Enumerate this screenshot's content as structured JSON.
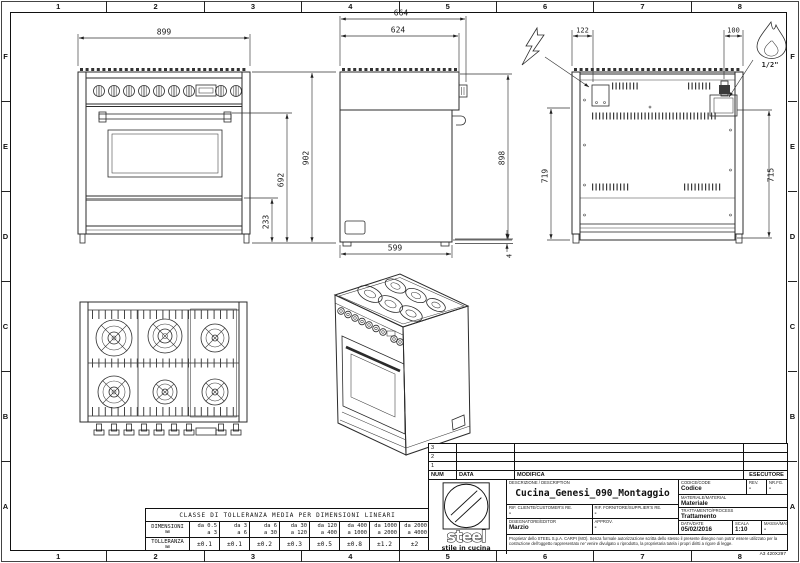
{
  "sheet": {
    "format_label": "A3 420X297",
    "grid_cols": [
      "1",
      "2",
      "3",
      "4",
      "5",
      "6",
      "7",
      "8"
    ],
    "grid_rows": [
      "F",
      "E",
      "D",
      "C",
      "B",
      "A"
    ]
  },
  "drawing": {
    "front_view": {
      "width": "899",
      "height": "902",
      "oven_height": "692",
      "plinth_height": "233"
    },
    "side_view": {
      "depth_total": "664",
      "depth_top": "624",
      "height_body": "898",
      "depth_base": "599",
      "foot": "4"
    },
    "rear_view": {
      "electrical_offset": "122",
      "gas_offset": "100",
      "height_left": "719",
      "height_right": "715",
      "gas_fitting": "1/2\""
    }
  },
  "tolerance_table": {
    "title": "CLASSE DI TOLLERANZA MEDIA PER DIMENSIONI LINEARI",
    "dim_label_1": "DIMENSIONI",
    "dim_label_2": "mm",
    "tol_label_1": "TOLLERANZA",
    "tol_label_2": "mm",
    "range_from": [
      "da 0.5",
      "da 3",
      "da 6",
      "da 30",
      "da 120",
      "da 400",
      "da 1000",
      "da 2000"
    ],
    "range_to": [
      "a 3",
      "a 6",
      "a 30",
      "a 120",
      "a 400",
      "a 1000",
      "a 2000",
      "a 4000"
    ],
    "values": [
      "±0.1",
      "±0.1",
      "±0.2",
      "±0.3",
      "±0.5",
      "±0.8",
      "±1.2",
      "±2"
    ]
  },
  "revision_table": {
    "rows": [
      "3",
      "2",
      "1"
    ],
    "col_num": "NUM",
    "col_data": "DATA",
    "col_modifica": "MODIFICA",
    "col_esecutore": "ESECUTORE"
  },
  "title_block": {
    "logo_word": "steel",
    "logo_tagline": "stile in cucina",
    "description_label": "DESCRIZIONE / DESCRIPTION",
    "description": "Cucina_Genesi_090_Montaggio",
    "codice_label": "CODICE/CODE",
    "codice": "Codice",
    "rev_label": "REV.",
    "rev": "-",
    "nrfg_label": "NR.FG.",
    "nrfg": "-",
    "materiale_label": "MATERIALE/MATERIAL",
    "materiale": "Materiale",
    "trattamento_label": "TRATTAMENTO/PROCESS",
    "trattamento": "Trattamento",
    "rif_cliente_label": "RIF. CLIENTE/CUSTOMER'S RE.",
    "rif_cliente": "-",
    "rif_fornitore_label": "RIF. FORNITORE/SUPPLIER'S RE.",
    "rif_fornitore": "-",
    "disegnatore_label": "DISEGNATORE/EDITOR",
    "disegnatore": "Marzio",
    "approv_label": "APPROV.",
    "approv": "-",
    "data_label": "DATA/DATE",
    "data_value": "05/02/2016",
    "scala_label": "SCALA",
    "scala": "1:10",
    "massa_label": "MASSA/MASS kg",
    "massa": "-",
    "legal": "Proprieta' dello STEEL S.p.A. CARPI (MO). Senza formale autorizzazione scritta dello stesso il presente disegno non potra' essere utilizzato per la costruzione dell'oggetto rappresentato ne' venire divulgato o riprodotto, la proprietaria tutela i propri diritti a rigore di legge."
  }
}
